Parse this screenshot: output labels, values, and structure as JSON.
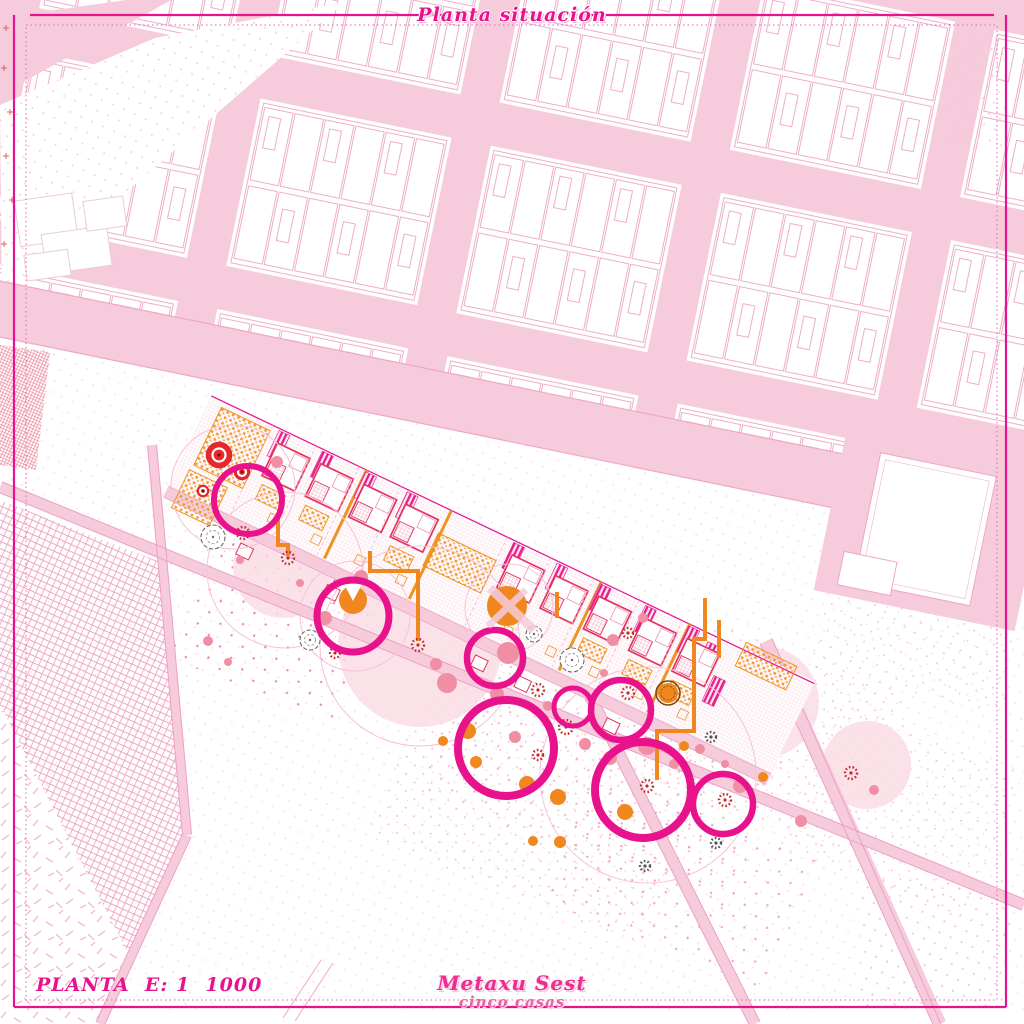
{
  "page": {
    "title": "Planta situación"
  },
  "footer": {
    "scale_label": "PLANTA",
    "scale_text": "E: 1  1000",
    "studio_name": "Metaxu Sest",
    "project_name": "cinco casas"
  },
  "palette": {
    "accent": "#E8128C",
    "street_pink": "#F6CCDD",
    "edge_pink": "#EE9FC2",
    "pale_canopy": "#FADBE4",
    "orange": "#F0871F",
    "red": "#E8272C",
    "salmon": "#F08FA4",
    "crimson_house": "#E4335F"
  },
  "plan": {
    "canopies": [
      [
        283,
        568,
        50
      ],
      [
        420,
        645,
        82
      ],
      [
        509,
        608,
        38
      ],
      [
        763,
        702,
        56
      ],
      [
        867,
        765,
        44
      ]
    ],
    "faint_circles": [
      [
        233,
        487,
        62
      ],
      [
        285,
        570,
        78
      ],
      [
        420,
        646,
        100
      ],
      [
        648,
        775,
        108
      ],
      [
        509,
        608,
        44
      ],
      [
        355,
        616,
        55
      ]
    ],
    "orange_paths": [
      "M278,517 L278,545 L288,545 L288,556",
      "M370,551 L370,571 L418,571 L418,641",
      "M705,598 L705,639 L694,639 L694,731 L657,731 L657,780",
      "M557,592 L557,618",
      "M719,620 L719,658"
    ],
    "rings": [
      [
        248,
        500,
        34,
        6
      ],
      [
        353,
        616,
        36,
        7
      ],
      [
        495,
        658,
        28,
        6.5
      ],
      [
        506,
        748,
        48,
        8
      ],
      [
        573,
        707,
        19,
        5
      ],
      [
        621,
        710,
        30,
        6.5
      ],
      [
        643,
        790,
        48,
        8
      ],
      [
        723,
        804,
        30,
        6.5
      ]
    ],
    "reds": [
      [
        219,
        455,
        13
      ],
      [
        242,
        472,
        8
      ],
      [
        203,
        491,
        6
      ]
    ],
    "pacman": [
      353,
      600,
      14
    ],
    "solids_orange": [
      [
        507,
        606,
        20
      ],
      [
        668,
        693,
        10,
        1
      ],
      [
        468,
        731,
        8
      ],
      [
        476,
        762,
        6
      ],
      [
        527,
        784,
        8
      ],
      [
        625,
        812,
        8
      ],
      [
        684,
        746,
        5
      ],
      [
        558,
        797,
        8
      ],
      [
        763,
        777,
        5
      ],
      [
        443,
        741,
        5
      ],
      [
        533,
        841,
        5
      ],
      [
        560,
        842,
        6
      ]
    ],
    "solids_salmon": [
      [
        277,
        462,
        6
      ],
      [
        325,
        618,
        7
      ],
      [
        361,
        577,
        7
      ],
      [
        300,
        583,
        4
      ],
      [
        508,
        653,
        11
      ],
      [
        497,
        694,
        7
      ],
      [
        515,
        737,
        6
      ],
      [
        548,
        706,
        5
      ],
      [
        553,
        740,
        4
      ],
      [
        585,
        744,
        6
      ],
      [
        604,
        673,
        4
      ],
      [
        610,
        758,
        7
      ],
      [
        647,
        746,
        9
      ],
      [
        674,
        764,
        5
      ],
      [
        700,
        749,
        5
      ],
      [
        740,
        786,
        7
      ],
      [
        725,
        764,
        4
      ],
      [
        801,
        821,
        6
      ],
      [
        874,
        790,
        5
      ],
      [
        208,
        641,
        5
      ],
      [
        228,
        662,
        4
      ],
      [
        240,
        560,
        4
      ],
      [
        643,
        618,
        5
      ],
      [
        447,
        683,
        10
      ],
      [
        436,
        664,
        6
      ],
      [
        613,
        640,
        6
      ]
    ],
    "asters_red": [
      [
        243,
        533,
        6
      ],
      [
        288,
        558,
        6
      ],
      [
        335,
        653,
        5
      ],
      [
        418,
        645,
        6
      ],
      [
        566,
        727,
        7
      ],
      [
        538,
        690,
        6
      ],
      [
        628,
        693,
        6
      ],
      [
        647,
        786,
        6
      ],
      [
        725,
        800,
        6
      ],
      [
        851,
        773,
        6
      ],
      [
        628,
        633,
        5
      ],
      [
        538,
        755,
        5
      ]
    ],
    "asters_dark": [
      [
        711,
        737,
        5
      ],
      [
        645,
        866,
        5
      ],
      [
        716,
        843,
        5
      ]
    ],
    "scallops": [
      [
        213,
        537,
        12
      ],
      [
        310,
        640,
        10
      ],
      [
        534,
        634,
        8
      ],
      [
        572,
        660,
        12
      ]
    ],
    "strip": {
      "modules": [
        {
          "x": 64,
          "conn": 0,
          "shed": 1,
          "patio": 1
        },
        {
          "x": 112,
          "conn": 1,
          "shed": 0,
          "patio": 1
        },
        {
          "x": 160,
          "conn": 0,
          "shed": 1,
          "patio": 0
        },
        {
          "x": 206,
          "conn": 1,
          "shed": 0,
          "patio": 1
        },
        {
          "x": 324,
          "conn": 0,
          "shed": 1,
          "patio": 1
        },
        {
          "x": 372,
          "conn": 1,
          "shed": 1,
          "patio": 0
        },
        {
          "x": 420,
          "conn": 0,
          "shed": 0,
          "patio": 1
        },
        {
          "x": 470,
          "conn": 1,
          "shed": 1,
          "patio": 1
        },
        {
          "x": 518,
          "conn": 0,
          "shed": 0,
          "patio": 1
        }
      ]
    }
  }
}
